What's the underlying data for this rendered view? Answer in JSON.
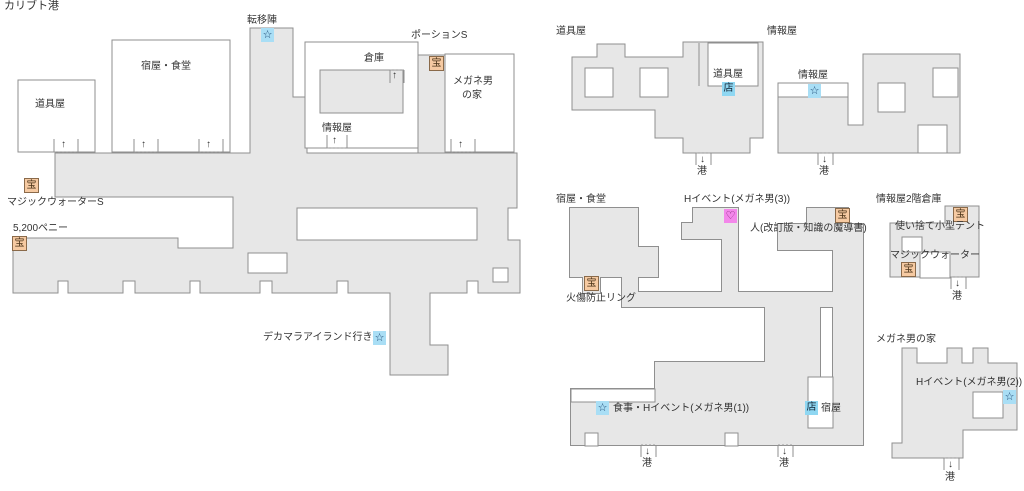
{
  "page_title": "カリブト港",
  "strings": {
    "port": "港",
    "arrow_up": "↑",
    "arrow_down": "↓"
  },
  "marker_glyphs": {
    "treasure": "宝",
    "star": "☆",
    "shop": "店",
    "heart": "♡"
  },
  "colors": {
    "floor": "#e7e7e7",
    "wall": "#8f8f8f",
    "treasure_bg": "#f6caa2",
    "star_bg": "#a9def5",
    "shop_bg": "#8fd7f2",
    "heart_bg": "#f387ea",
    "text": "#333333"
  },
  "main_map": {
    "teleport_label": "転移陣",
    "inn_label": "宿屋・食堂",
    "item_shop_label": "道具屋",
    "warehouse_label": "倉庫",
    "potion_label": "ポーションS",
    "glasses_house_label_1": "メガネ男",
    "glasses_house_label_2": "の家",
    "info_shop_label": "情報屋",
    "magic_water_label": "マジックウォーターS",
    "penny_label": "5,200ペニー",
    "ship_label": "デカマラアイランド行き船"
  },
  "item_shop_map": {
    "title": "道具屋",
    "room_label": "道具屋"
  },
  "info_shop_map": {
    "title": "情報屋",
    "room_label": "情報屋"
  },
  "inn_map": {
    "title": "宿屋・食堂",
    "h_event3_label": "Hイベント(メガネ男(3))",
    "person_label": "人(改訂版・知識の魔導書)",
    "burn_ring_label": "火傷防止リング",
    "meal_event_label": "食事・Hイベント(メガネ男(1))",
    "inn_label": "宿屋"
  },
  "warehouse2f_map": {
    "title": "情報屋2階倉庫",
    "tent_label": "使い捨て小型テント",
    "magic_water_label": "マジックウォーター"
  },
  "glasses_house_map": {
    "title": "メガネ男の家",
    "h_event2_label": "Hイベント(メガネ男(2))"
  }
}
